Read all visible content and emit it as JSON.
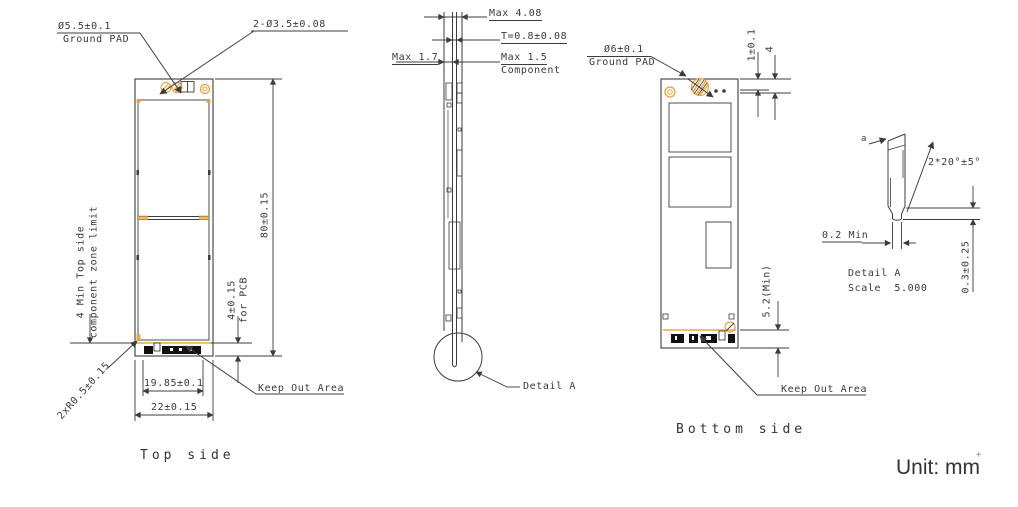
{
  "unit_note": "Unit: mm",
  "cursor_artifact": "+",
  "colors": {
    "line": "#3c3c3c",
    "accent": "#E8A33C",
    "keepout": "#F2A83C",
    "pad": "#111111"
  },
  "top_view": {
    "caption": "Top side",
    "ground_pad_dia": "Ø5.5±0.1",
    "ground_pad_label": "Ground PAD",
    "holes_dia": "2-Ø3.5±0.08",
    "zone_limit_line1": "4 Min Top side",
    "zone_limit_line2": "component zone limit",
    "corner_radius": "2xR0.5±0.15",
    "pcb_offset": "4±0.15",
    "pcb_offset_note": "for PCB",
    "board_length": "80±0.15",
    "connector_width": "19.85±0.1",
    "board_width": "22±0.15",
    "keep_out": "Keep Out Area"
  },
  "side_view": {
    "max_total": "Max 4.08",
    "thickness": "T=0.8±0.08",
    "max_bottom": "Max 1.7",
    "max_top": "Max 1.5",
    "component_label": "Component",
    "detail_ref": "Detail A"
  },
  "bottom_view": {
    "caption": "Bottom side",
    "ground_pad_dia": "Ø6±0.1",
    "ground_pad_label": "Ground PAD",
    "edge_gap": "1±0.1",
    "pad_offset": "4",
    "connector_height": "5.2(Min)",
    "keep_out": "Keep Out Area"
  },
  "detail_a": {
    "datum": "a",
    "chamfer_angle": "2*20°±5°",
    "min_width": "0.2 Min",
    "tip_height": "0.3±0.25",
    "title": "Detail A",
    "scale": "Scale  5.000"
  }
}
